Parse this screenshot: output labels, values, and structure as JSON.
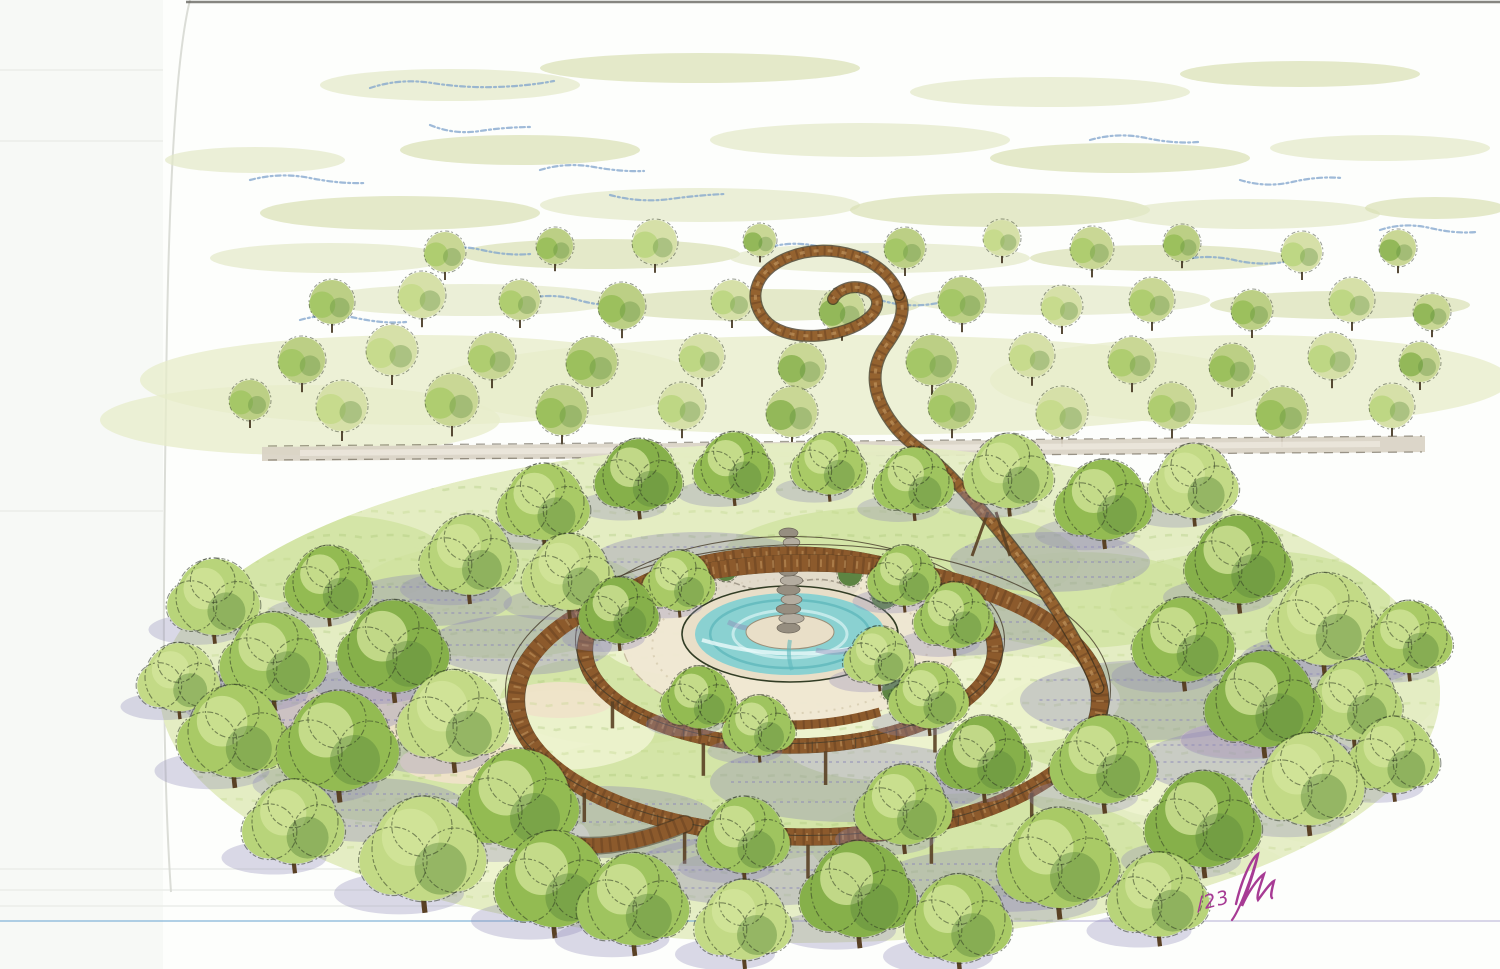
{
  "canvas": {
    "w": 1500,
    "h": 969
  },
  "signature": {
    "year_mark": "/23",
    "color": "#a73b94"
  },
  "palette": {
    "paper": "#fdfefc",
    "paper_left": "#f6f8f5",
    "crease": "#d9dbd5",
    "scanline": "#e9ebe7",
    "top_edge": "#5f5e58",
    "ruled": "#7fb2d8",
    "ruled2": "#9a93c8",
    "ink": "#2f3a22",
    "pencil": "#7fa3cc",
    "sky_wash": [
      "#e3e8c8",
      "#d8e0b4"
    ],
    "distant_wash": "#e7ecc9",
    "foliage": [
      "#a9ca66",
      "#93bb52",
      "#b8d47a",
      "#86b04a",
      "#9fc45f",
      "#c3da86"
    ],
    "foliage_light": "#d4e59c",
    "foliage_dark": "#5d8a3c",
    "distant": [
      "#c9d795",
      "#bccf85",
      "#d6e0a8"
    ],
    "trunk": "#5a4124",
    "trunk_ink": "#3c2d18",
    "grass_base": "#e4edc2",
    "grass_mid": "#cfe2a0",
    "grass_bright": "#edf3cf",
    "grass_tex": "#b7d07c",
    "grass_tex2": "#9fbf6b",
    "shadow": "#8e89b6",
    "shadow_tex": "#8d88b8",
    "sand": "#efe3c8",
    "plaza": "#efe7d3",
    "plaza_edge": "#b8ab8d",
    "plaza_speckle": "#cdc1a3",
    "rim": "#e9dfc8",
    "water": "#8ad1d1",
    "water_dark": "#5fb8bc",
    "water_light": "#c9ecec",
    "stone": "#b4ada0",
    "stone_dark": "#968e80",
    "rock_line": "#8a8272",
    "deck": "#8c5a2c",
    "deck_dark": "#5d3a1e",
    "deck_light": "#c79b64",
    "rail": "#463c2b",
    "road": "#d9d2c4",
    "road_ink": "#57503f",
    "road_light": "#f3efe6",
    "bush": "#4e7a33"
  },
  "paper": {
    "left_strip_w": 163,
    "crease_path": "M 190 0 C 175 60 168 200 166 400 C 163 600 162 760 171 892",
    "top_edge": {
      "x1": 186,
      "y": 2,
      "x2": 1500
    },
    "scanlines": [
      [
        0,
        70,
        163
      ],
      [
        0,
        141,
        163
      ],
      [
        0,
        511,
        163
      ],
      [
        0,
        869,
        520
      ],
      [
        0,
        890,
        420
      ],
      [
        0,
        906,
        560
      ]
    ],
    "ruled_line_y": 921
  },
  "sky": {
    "washes": [
      [
        450,
        85,
        130,
        16
      ],
      [
        700,
        68,
        160,
        15
      ],
      [
        1050,
        92,
        140,
        15
      ],
      [
        1300,
        74,
        120,
        13
      ],
      [
        255,
        160,
        90,
        13
      ],
      [
        520,
        150,
        120,
        15
      ],
      [
        860,
        140,
        150,
        17
      ],
      [
        1120,
        158,
        130,
        15
      ],
      [
        1380,
        148,
        110,
        13
      ],
      [
        400,
        213,
        140,
        17
      ],
      [
        700,
        205,
        160,
        17
      ],
      [
        1000,
        210,
        150,
        17
      ],
      [
        1250,
        214,
        130,
        15
      ],
      [
        1435,
        208,
        70,
        11
      ],
      [
        330,
        258,
        120,
        15
      ],
      [
        600,
        254,
        140,
        15
      ],
      [
        880,
        258,
        150,
        15
      ],
      [
        1160,
        258,
        130,
        13
      ],
      [
        470,
        300,
        150,
        16
      ],
      [
        760,
        305,
        160,
        16
      ],
      [
        1060,
        300,
        150,
        15
      ],
      [
        1340,
        305,
        130,
        14
      ]
    ],
    "distant_wash": [
      [
        420,
        380,
        280,
        45
      ],
      [
        850,
        385,
        420,
        50
      ],
      [
        1250,
        380,
        260,
        45
      ],
      [
        300,
        420,
        200,
        35
      ]
    ],
    "pencil_strokes": [
      "M 370 88 q 30 -10 62 -5 t 64 4 t 58 -6",
      "M 430 125 q 24 10 50 6 t 52 -4",
      "M 250 180 q 30 -8 60 -2 t 55 5",
      "M 540 170 q 26 -8 54 -3 t 50 4",
      "M 610 195 q 30 8 60 4 t 55 -5",
      "M 760 250 q 28 -10 56 -4 t 52 6",
      "M 520 300 q 30 -8 58 0 t 54 4",
      "M 880 300 q 26 8 52 4 t 50 -6",
      "M 1090 140 q 28 -8 56 -2 t 52 4",
      "M 1240 180 q 26 8 52 2 t 50 -4",
      "M 1380 230 q 24 -8 50 -2 t 46 4",
      "M 1180 260 q 28 -6 54 0 t 50 2",
      "M 430 250 q 26 -6 52 0 t 48 4",
      "M 300 320 q 28 -8 56 -2 t 50 4"
    ]
  },
  "road": {
    "band": "M 262 447 L 1425 436 L 1425 452 L 262 461 Z",
    "edge_top": "M 268 446 L 1422 436",
    "edge_bottom": "M 268 460 L 1422 452",
    "highlight": "M 300 453 L 1380 444"
  },
  "distant_trees": [
    [
      445,
      252,
      20
    ],
    [
      555,
      246,
      18
    ],
    [
      655,
      242,
      22
    ],
    [
      760,
      240,
      16
    ],
    [
      905,
      248,
      20
    ],
    [
      1002,
      238,
      18
    ],
    [
      1092,
      248,
      21
    ],
    [
      1182,
      243,
      18
    ],
    [
      1302,
      252,
      20
    ],
    [
      1398,
      248,
      18
    ],
    [
      332,
      302,
      22
    ],
    [
      422,
      295,
      23
    ],
    [
      520,
      300,
      20
    ],
    [
      622,
      306,
      23
    ],
    [
      732,
      300,
      20
    ],
    [
      842,
      310,
      22
    ],
    [
      962,
      300,
      23
    ],
    [
      1062,
      306,
      20
    ],
    [
      1152,
      300,
      22
    ],
    [
      1252,
      310,
      20
    ],
    [
      1352,
      300,
      22
    ],
    [
      1432,
      312,
      18
    ],
    [
      302,
      360,
      23
    ],
    [
      392,
      350,
      25
    ],
    [
      492,
      356,
      23
    ],
    [
      592,
      362,
      25
    ],
    [
      702,
      356,
      22
    ],
    [
      802,
      366,
      23
    ],
    [
      932,
      360,
      25
    ],
    [
      1032,
      355,
      22
    ],
    [
      1132,
      360,
      23
    ],
    [
      1232,
      366,
      22
    ],
    [
      1332,
      356,
      23
    ],
    [
      1420,
      362,
      20
    ],
    [
      250,
      400,
      20
    ],
    [
      342,
      406,
      25
    ],
    [
      452,
      400,
      26
    ],
    [
      562,
      410,
      25
    ],
    [
      682,
      406,
      23
    ],
    [
      792,
      412,
      25
    ],
    [
      952,
      406,
      23
    ],
    [
      1062,
      412,
      25
    ],
    [
      1172,
      406,
      23
    ],
    [
      1282,
      412,
      25
    ],
    [
      1392,
      406,
      22
    ]
  ],
  "park": {
    "clip": {
      "cx": 800,
      "cy": 693,
      "rx": 640,
      "ry": 250
    },
    "ground": [
      [
        660,
        560,
        430,
        120
      ],
      [
        400,
        660,
        270,
        150
      ],
      [
        1150,
        650,
        310,
        150
      ],
      [
        795,
        705,
        440,
        205
      ],
      [
        500,
        800,
        330,
        140
      ],
      [
        1080,
        805,
        330,
        140
      ],
      [
        790,
        880,
        510,
        85
      ],
      [
        275,
        705,
        185,
        155
      ],
      [
        1335,
        705,
        165,
        140
      ],
      [
        795,
        500,
        520,
        70
      ]
    ],
    "mid_patches": [
      [
        500,
        600,
        150,
        58
      ],
      [
        900,
        560,
        180,
        54
      ],
      [
        700,
        800,
        200,
        66
      ],
      [
        1150,
        720,
        160,
        58
      ],
      [
        400,
        765,
        140,
        58
      ],
      [
        1250,
        600,
        140,
        50
      ],
      [
        620,
        700,
        120,
        45
      ],
      [
        980,
        845,
        170,
        52
      ],
      [
        330,
        560,
        120,
        45
      ],
      [
        1080,
        600,
        130,
        48
      ]
    ],
    "bright_patches": [
      [
        560,
        730,
        95,
        40
      ],
      [
        1010,
        700,
        110,
        44
      ],
      [
        690,
        640,
        90,
        36
      ],
      [
        880,
        740,
        100,
        40
      ],
      [
        480,
        840,
        110,
        42
      ],
      [
        1190,
        780,
        100,
        40
      ]
    ],
    "sand": [
      [
        358,
        716,
        88,
        26
      ],
      [
        470,
        762,
        70,
        22
      ],
      [
        560,
        700,
        55,
        18
      ],
      [
        1240,
        740,
        60,
        18
      ]
    ],
    "shadows": [
      [
        300,
        700,
        120,
        40
      ],
      [
        520,
        645,
        92,
        30
      ],
      [
        700,
        562,
        110,
        30
      ],
      [
        950,
        622,
        120,
        34
      ],
      [
        1150,
        700,
        130,
        40
      ],
      [
        850,
        782,
        140,
        40
      ],
      [
        600,
        822,
        120,
        36
      ],
      [
        1250,
        762,
        110,
        34
      ],
      [
        430,
        600,
        82,
        26
      ],
      [
        1050,
        562,
        100,
        30
      ],
      [
        760,
        870,
        130,
        36
      ],
      [
        1000,
        880,
        120,
        32
      ],
      [
        370,
        810,
        100,
        32
      ],
      [
        1330,
        660,
        90,
        28
      ]
    ]
  },
  "fountain": {
    "plaza": {
      "cx": 790,
      "cy": 640,
      "rx": 168,
      "ry": 84
    },
    "rim": {
      "cx": 790,
      "cy": 634,
      "rx": 108,
      "ry": 48
    },
    "water": {
      "cx": 790,
      "cy": 634,
      "rx": 95,
      "ry": 41
    },
    "island": {
      "cx": 790,
      "cy": 632,
      "rx": 44,
      "ry": 17
    },
    "column": {
      "x": 790,
      "top": 528,
      "bottom": 628
    },
    "rocks": {
      "cx": 770,
      "cy": 585,
      "rx": 90,
      "ry": 24
    },
    "bushes": [
      [
        678,
        592,
        13
      ],
      [
        726,
        570,
        11
      ],
      [
        850,
        574,
        12
      ],
      [
        884,
        596,
        13
      ],
      [
        688,
        696,
        12
      ],
      [
        894,
        690,
        12
      ]
    ],
    "bench": "M 700 712 Q 790 738 880 712"
  },
  "boardwalk": {
    "inner": {
      "cx": 790,
      "cy": 650,
      "rx": 205,
      "ry": 96,
      "w": 15
    },
    "outer": {
      "cx": 808,
      "cy": 700,
      "rx": 292,
      "ry": 137,
      "w": 17
    },
    "supports_inner": [
      45,
      80,
      115,
      150
    ],
    "supports_outer": [
      40,
      65,
      90,
      115,
      140,
      160
    ],
    "ramp_tail": "M 685 824 C 640 843 596 851 556 842"
  },
  "north_path": {
    "main": "M 1098 688 C 1072 622 1008 536 952 478 C 931 456 912 446 897 429 C 872 399 868 369 887 344 C 899 327 907 310 899 295",
    "loop": "M 899 295 C 886 256 828 241 789 257 C 751 272 747 303 768 323 C 792 344 845 337 867 319 C 883 307 879 292 862 288 C 849 285 837 291 833 299",
    "aframe": [
      [
        988,
        512,
        972,
        556
      ],
      [
        996,
        512,
        1010,
        556
      ]
    ]
  }
}
